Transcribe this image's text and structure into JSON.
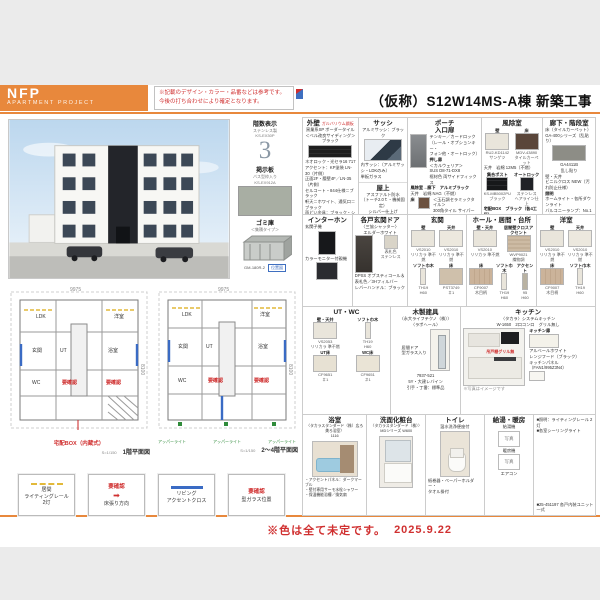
{
  "header": {
    "logo1": "NFP",
    "logo2": "APARTMENT  PROJECT",
    "notice": "※記載のデザイン・カラー・品番などは参考です。\n今後の打ち合わせにより確定となります。",
    "title": "（仮称）S12W14MS-A棟 新築工事"
  },
  "side": {
    "floor_sign": {
      "title": "階数表示",
      "sub": "ステンレス製\nKS-EX30P",
      "numeral": "3"
    },
    "board": {
      "title": "掲示板",
      "sub": "バス型枠入り\nKS-EX912A"
    },
    "garbage": {
      "title": "ゴミ庫",
      "sub": "＜集積タイプ＞",
      "code": "GM-180R-2",
      "tag": "位置図"
    }
  },
  "plans": {
    "p1": {
      "caption": "1階平面図",
      "scale": "S=1/150",
      "dim_top": "9975",
      "dim_side": "8100",
      "rooms": [
        "LDK",
        "洋室",
        "玄関",
        "UT",
        "浴室",
        "WC"
      ],
      "flags": [
        "要確認",
        "要確認"
      ],
      "note": "宅配BOX（内蔵式）"
    },
    "p2": {
      "caption": "2〜4階平面図",
      "scale": "S=1/150",
      "dim_top": "9975",
      "dim_side": "8100",
      "rooms": [
        "LDK",
        "洋室",
        "玄関",
        "UT",
        "浴室",
        "WC"
      ],
      "flags": [
        "要確認",
        "要確認"
      ],
      "lights": [
        "アッパーライト",
        "アッパーライト",
        "アッパーライト"
      ]
    }
  },
  "legend": [
    {
      "lines": "居間\nライティングレール\n2灯"
    },
    {
      "title": "要確認",
      "mark": "➡",
      "lines": "床張り方向"
    },
    {
      "lines": "リビング\nアクセントクロス"
    },
    {
      "title": "要確認",
      "lines": "型ガラス位置"
    }
  ],
  "specs": {
    "gaiheki": {
      "title": "外壁",
      "tag": "ガルバリウム鋼板",
      "body1": "窯業系SP ボーダータイル\n＜ベル改良サイディング＞\nブラック",
      "swatch_code": "ネオロック・光セラ16 717",
      "body2": "アクセント：KP塗装 LN-30（片側）\n正面2F・腰壁4F／LN-35（片側）",
      "body3": "セルコート・844仕様＝ブラック\n軒天＝ホワイト、通気口＝ブラック\n雨どい金具：ブラック・シルバー"
    },
    "sash": {
      "title": "サッシ",
      "sub": "アルミサッシ：ブラック",
      "body": "内サッシ：（アルミサッシ・LDKのみ）\n単板ガラス"
    },
    "okujo": {
      "title": "屋上",
      "body": "アスファルト防水\n（トーチ2.0ｔ・機械固定）\nシルバー仕上げ"
    },
    "porch": {
      "title": "ポーチ\n入口扉",
      "body": "テンキー／カードロック\n（レール・オプションキー・\nフォン他・オートロック）",
      "door_label": "押し扉",
      "door_body": "＜カルウェリア＞\nSUS D8-71-DX8\n框材色 両サイドフィックス",
      "line1": "風除室→廊下　アルミブラック",
      "line2": "天井　岩綿 NAG（不燃）",
      "floor": {
        "label": "床",
        "code": "＜玉石調セラミックタイル＞\n300角タイル サイパーン・乱貼り"
      }
    },
    "fujo": {
      "title": "風除室",
      "wall": {
        "label": "壁",
        "code": "RU2-KD1142\nサンゲツ"
      },
      "floor": {
        "label": "床",
        "code": "MDV-43890\nタイルカーペット"
      },
      "ceil": "天井　岩綿 12M5（不燃）",
      "post_label": "集合ポスト",
      "post_code": "KS-MB5002PU\nブラック",
      "lock_label": "オートロック",
      "lock_code": "ステンレス\nヘアライン仕上",
      "box": "宅配BOX　ブラック（各4工区）"
    },
    "rouka": {
      "title": "廊下・階段室",
      "floor": "床（タイルカーペット）\nGA-400シリーズ（乱貼り）",
      "swatch_code": "GA4411B\n乱し貼り",
      "wall": "壁・天井\nビニルクロス NEW（汚れ防止仕様）",
      "light_label": "照明",
      "light_body": "ホームライト・各所ダウンライト\nバルコニーランプ：No.1 Fホワイト\n廊下・階段：ダウンライト"
    },
    "interphone": {
      "title": "インターホン",
      "l1": "玄関子機",
      "l2": "カラーモニター付親機"
    },
    "door": {
      "title": "各戸玄関ドア",
      "sub": "〈三協シャッター〉\nエルダーホワイト",
      "plate": "表札色\nステンレス",
      "body": "DPSS オプスティコール＆\n表札色／3Hフィルバー\nレバーハンドル：ブラック"
    },
    "genkan": {
      "title": "玄関",
      "wall": {
        "label": "壁",
        "code": "VS2010\nリリカラ 準不燃"
      },
      "ceil": {
        "label": "天井",
        "code": "VS2010\nリリカラ 準不燃"
      },
      "skirt": {
        "label": "ソフト巾木",
        "code": "TH19\nH60"
      },
      "floor": {
        "label": "床",
        "code": "PST3749\n＃1"
      }
    },
    "hall": {
      "title": "ホール・居間・台所",
      "wall": {
        "label": "壁・天井",
        "code": "VS2010\nリリカラ 準不燃"
      },
      "accent": {
        "label": "居間壁クロスアクセント",
        "code": "WVP9021\n織物調"
      },
      "floor": {
        "label": "床",
        "code": "CF9007\n木目柄"
      },
      "skirt": {
        "label": "ソフト巾木",
        "code": "TH19\nH60"
      },
      "accent2": {
        "label": "アクセント",
        "code": "95\nH60"
      }
    },
    "yoshitsu": {
      "title": "洋室",
      "wall": {
        "label": "壁",
        "code": "VS2010\nリリカラ 準不燃"
      },
      "ceil": {
        "label": "天井",
        "code": "VS2010\nリリカラ 準不燃"
      },
      "floor": {
        "label": "床",
        "code": "CF9007\n木目柄"
      },
      "skirt": {
        "label": "ソフト巾木",
        "code": "TH19\nH60"
      }
    },
    "utwc": {
      "title": "UT・WC",
      "wall": {
        "label": "壁・天井",
        "code": "VS2053\nリリカラ 準不燃"
      },
      "skirt": {
        "label": "ソフト巾木",
        "code": "TH19\nH60"
      },
      "ut": {
        "label": "UT床",
        "code": "CF9651\n＃1"
      },
      "wc": {
        "label": "WC床",
        "code": "CF9651\n＃1"
      }
    },
    "tategu": {
      "title": "木製建具",
      "sub": "〈永大ライフテクノ（株）〉\n〈ラポヘール〉",
      "left": "居間ドア\n型ガラス入り",
      "code": "7937-521\n5Y・大建レバイン",
      "note": "引手・丁番：標準品"
    },
    "kitchen": {
      "title": "キッチン",
      "sub": "〈タカラ〉システムキッチン\nW-1650　2口コンロ　グリル無し",
      "red": "吊戸棚グリル無",
      "door_label": "キッチン扉",
      "door_code": "アルベールホワイト",
      "hood": "レンジフード（ブラック）",
      "panel": "キッチンパネル\n（FAN1/995Z3N4）",
      "img_note": "※写真はイメージです"
    },
    "bath": {
      "title": "浴室",
      "sub": "〈タカラスタンダード（株）広ろ美ろ浴室〉\n1116",
      "body": "・アクセントパネル：ダークマーブル\n・壁付専用サーモ水栓シャワー\n・保温機能浴槽／換気扇"
    },
    "vanity": {
      "title": "洗面化粧台",
      "sub": "〈タカラスタンダード（株）〉\nMDシリーズ W600"
    },
    "toilet": {
      "title": "トイレ",
      "sub": "温水洗浄便座付",
      "note": "紙巻器・ペーパーホルダー・\nタオル掛付"
    },
    "water": {
      "title": "給湯・暖房",
      "l1": "給湯機",
      "p1": "写真",
      "l2": "暖房機",
      "p2": "写真",
      "l3": "エアコン"
    },
    "notes": {
      "l1": "■照明：ライティングレール 2灯\n■各室シーリングライト",
      "l2": "■25-451197 各戸内装ユニット一式"
    }
  },
  "footer": {
    "note": "※色は全て未定です。",
    "date": "2025.9.22"
  }
}
